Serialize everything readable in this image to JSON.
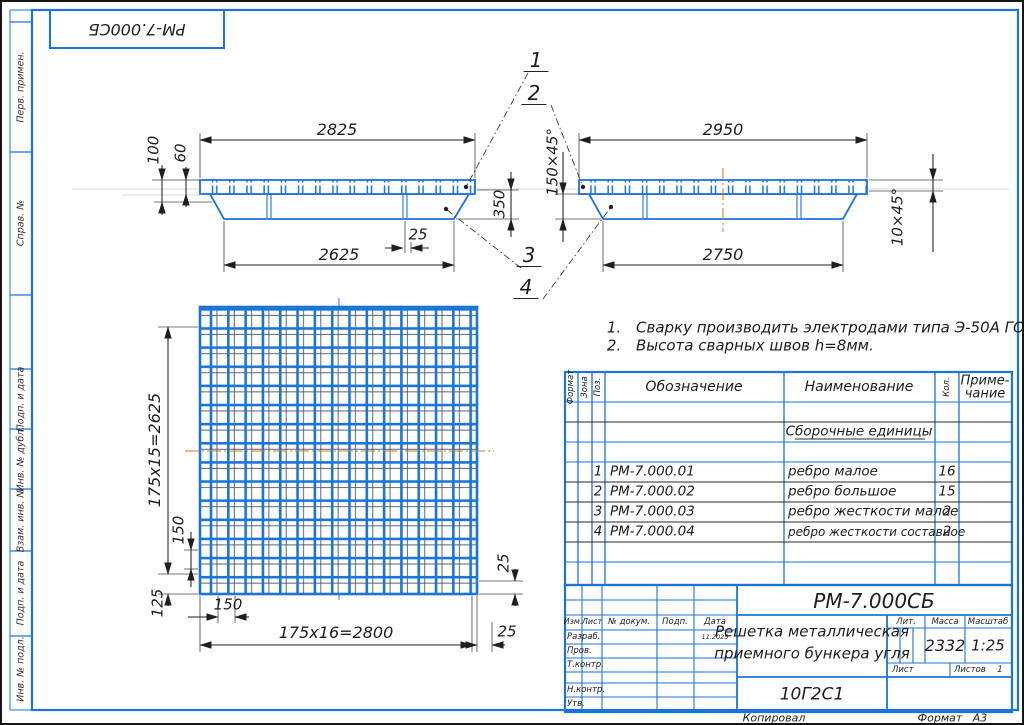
{
  "sheet": {
    "stamp_top": "РМ-7.000СБ",
    "copied": "Копировал",
    "format_label": "Формат",
    "format_value": "А3"
  },
  "margin": {
    "labels": [
      "Перв. примен.",
      "Справ. №",
      "Подп. и дата",
      "Инв. № дубл.",
      "Взам. инв. №",
      "Подп. и дата",
      "Инв. № подл."
    ]
  },
  "views": {
    "callouts": [
      "1",
      "2",
      "3",
      "4"
    ],
    "left": {
      "dim_top": "2825",
      "dim_bottom": "2625",
      "dim_offset": "25",
      "dim_height_outer": "100",
      "dim_height_bar": "60",
      "dim_depth": "350"
    },
    "right": {
      "dim_top": "2950",
      "dim_bottom": "2750",
      "chamfer_left": "150×45°",
      "chamfer_right": "10×45°"
    },
    "plan": {
      "dim_left": "175x15=2625",
      "dim_bottom": "175x16=2800",
      "dim_pitch_v": "150",
      "dim_pitch_h": "150",
      "dim_margin": "125",
      "dim_edge_v": "25",
      "dim_edge_h": "25"
    }
  },
  "notes": {
    "items": [
      {
        "num": "1.",
        "text": "Сварку производить электродами типа Э-50А ГОСТ 5058"
      },
      {
        "num": "2.",
        "text": "Высота сварных швов h=8мм."
      }
    ]
  },
  "spec": {
    "headers": {
      "format": "Формат",
      "zone": "Зона",
      "pos": "Поз.",
      "designation": "Обозначение",
      "name": "Наименование",
      "qty": "Кол.",
      "note1": "Приме-",
      "note2": "чание"
    },
    "section": "Сборочные единицы",
    "rows": [
      {
        "pos": "1",
        "designation": "РМ-7.000.01",
        "name": "ребро малое",
        "qty": "16"
      },
      {
        "pos": "2",
        "designation": "РМ-7.000.02",
        "name": "ребро большое",
        "qty": "15"
      },
      {
        "pos": "3",
        "designation": "РМ-7.000.03",
        "name": "ребро жесткости малое",
        "qty": "2"
      },
      {
        "pos": "4",
        "designation": "РМ-7.000.04",
        "name": "ребро жесткости составное",
        "qty": "2"
      }
    ]
  },
  "titleblock": {
    "designation": "РМ-7.000СБ",
    "title_line1": "Решетка металлическая",
    "title_line2": "приемного бункера угля",
    "material": "10Г2С1",
    "labels": {
      "izm": "Изм.",
      "list": "Лист",
      "doc": "№ докум.",
      "podp": "Подп.",
      "data": "Дата",
      "razrab": "Разраб.",
      "prov": "Пров.",
      "tkontr": "Т.контр.",
      "nkontr": "Н.контр.",
      "utv": "Утв.",
      "lit": "Лит.",
      "massa": "Масса",
      "masshtab": "Масштаб",
      "list2": "Лист",
      "listov": "Листов"
    },
    "values": {
      "massa": "2332",
      "masshtab": "1:25",
      "listov": "1",
      "date": "11.2025"
    }
  }
}
